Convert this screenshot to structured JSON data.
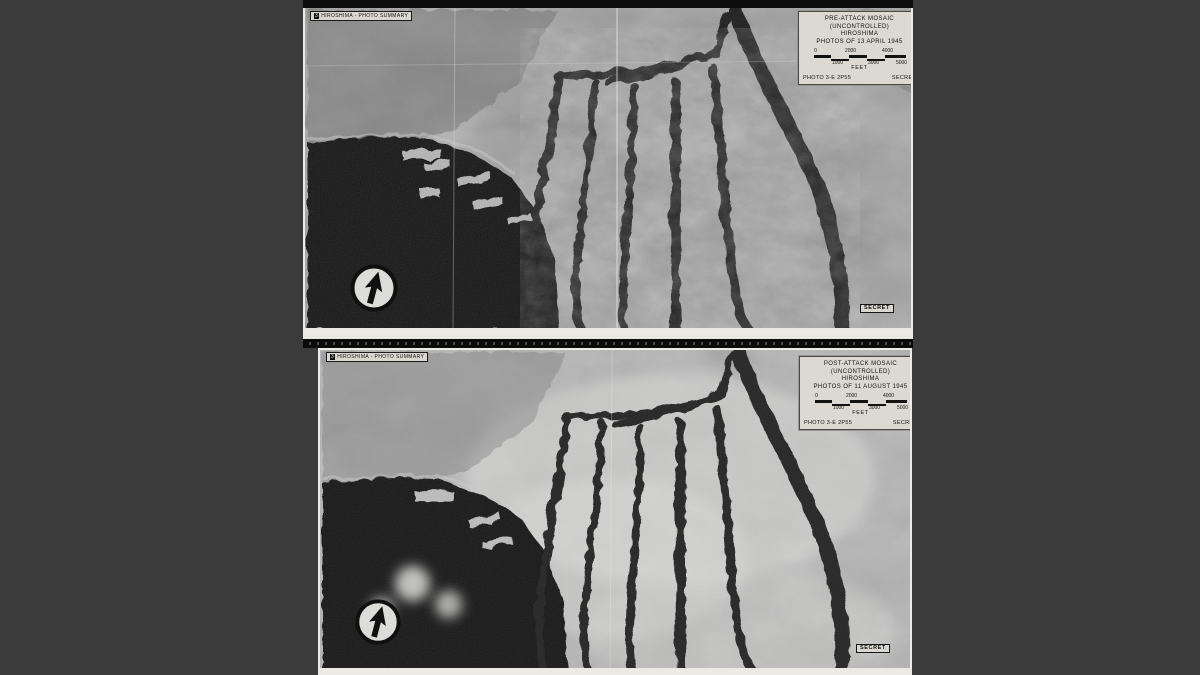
{
  "colors": {
    "background": "#3b3b3b",
    "card_background": "#dbd9d1",
    "ink": "#14140f",
    "film_black": "#0c0c0c"
  },
  "icons": {
    "north_arrow": "compass-north-arrow"
  },
  "panels": [
    {
      "corner_badge": "3",
      "corner_label": "HIROSHIMA - PHOTO SUMMARY",
      "card": {
        "line1": "PRE-ATTACK  MOSAIC",
        "line2": "(UNCONTROLLED)",
        "line3": "HIROSHIMA",
        "line4": "PHOTOS OF 13 APRIL 1945",
        "scale_upper": [
          "0",
          "2000",
          "4000"
        ],
        "scale_lower": [
          "1000",
          "3000",
          "5000"
        ],
        "unit": "FEET",
        "photo_ref": "PHOTO 3-E 2P55",
        "classification": "SECRET"
      },
      "stamp": "SECRET"
    },
    {
      "corner_badge": "3",
      "corner_label": "HIROSHIMA - PHOTO SUMMARY",
      "card": {
        "line1": "POST-ATTACK  MOSAIC",
        "line2": "(UNCONTROLLED)",
        "line3": "HIROSHIMA",
        "line4": "PHOTOS OF 11 AUGUST 1945",
        "scale_upper": [
          "0",
          "2000",
          "4000"
        ],
        "scale_lower": [
          "1000",
          "3000",
          "5000"
        ],
        "unit": "FEET",
        "photo_ref": "PHOTO 3-E 2P55",
        "classification": "SECRET"
      },
      "stamp": "SECRET"
    }
  ]
}
